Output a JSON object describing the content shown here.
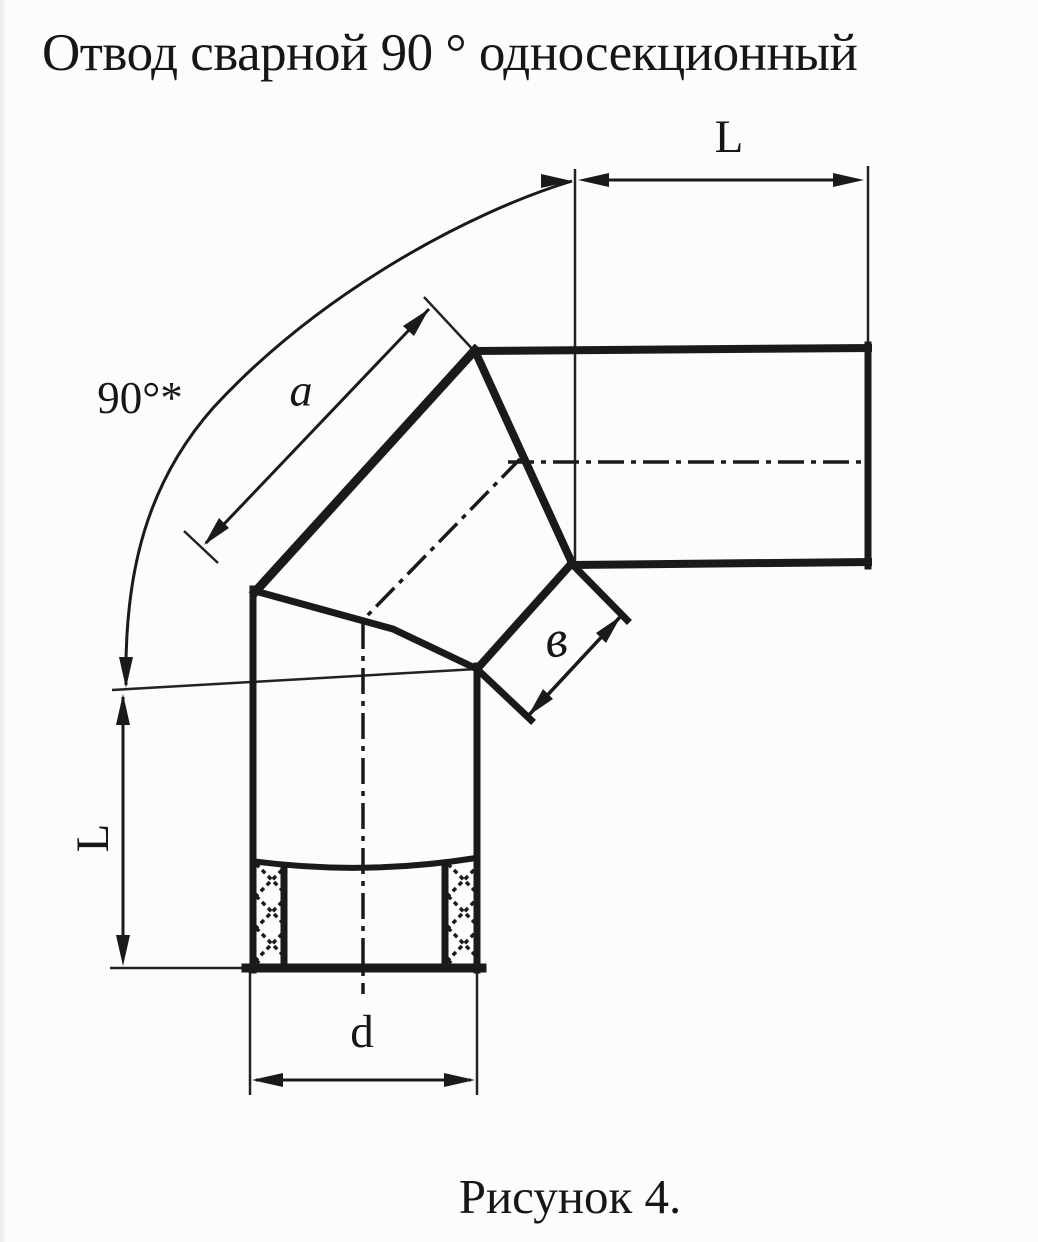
{
  "title": "Отвод сварной 90 ° односекционный",
  "caption": "Рисунок 4.",
  "dimensions": {
    "angle": "90°*",
    "top_pipe_length": "L",
    "bottom_pipe_length": "L",
    "section_outer_side": "a",
    "section_inner_side": "в",
    "diameter": "d"
  },
  "colors": {
    "ink": "#1a1a1a",
    "paper": "#fcfcfa"
  }
}
